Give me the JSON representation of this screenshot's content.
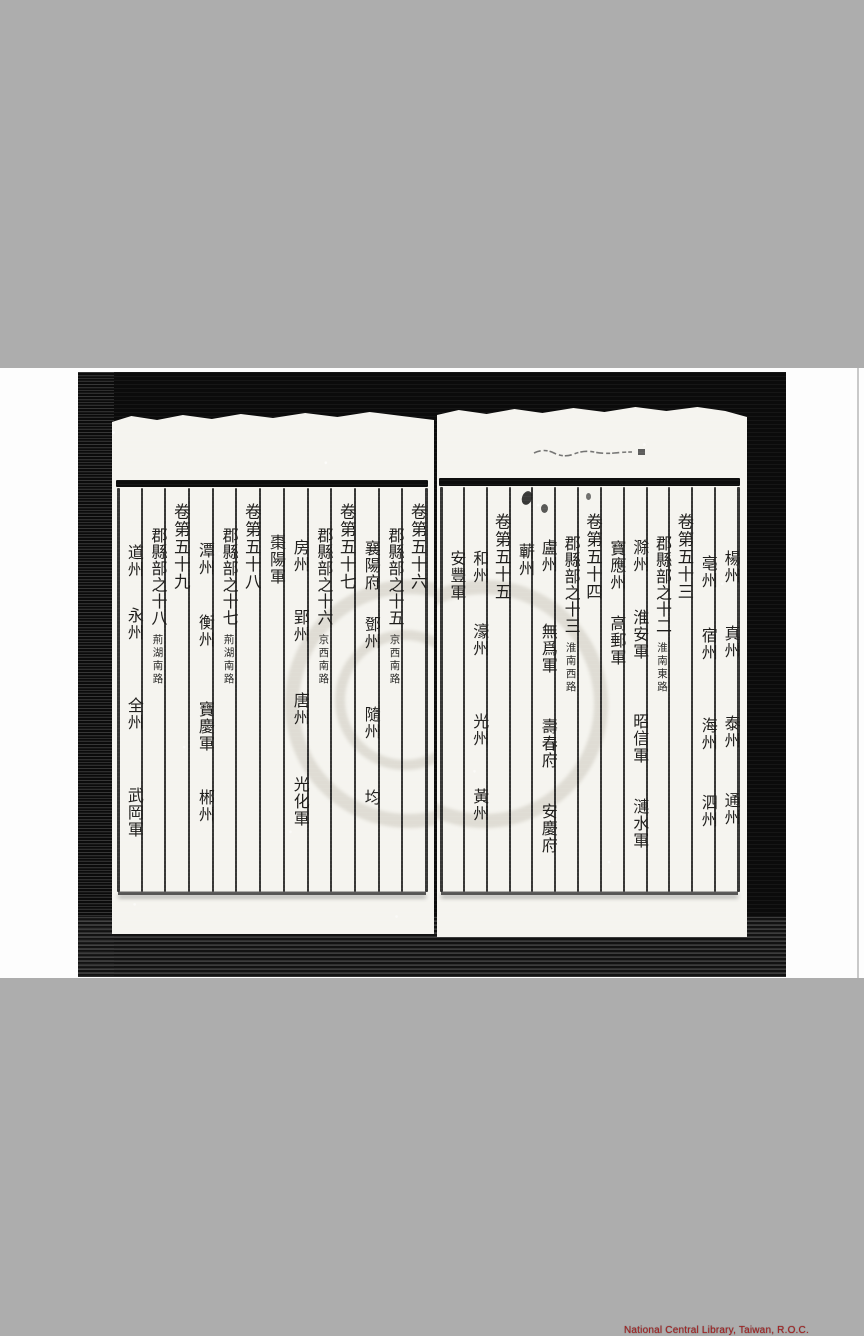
{
  "viewer": {
    "watermark_text": "National Central Library, Taiwan, R.O.C.",
    "watermark_color": "#a82020",
    "background_gray": "#adadad",
    "panel_white": "#fdfdfd",
    "scan_black": "#0b0b0b",
    "paper_color": "#f5f4ef",
    "ink_color": "#1e1d1b"
  },
  "book": {
    "description": "table of contents of a Chinese classical gazetteer, vertical columns read right to left",
    "right_page": {
      "columns": [
        {
          "items": [
            {
              "t": "楊州",
              "y": 145
            },
            {
              "t": "真州",
              "y": 220
            },
            {
              "t": "泰州",
              "y": 310
            },
            {
              "t": "通州",
              "y": 387
            }
          ]
        },
        {
          "items": [
            {
              "t": "亳州",
              "y": 150
            },
            {
              "t": "宿州",
              "y": 222
            },
            {
              "t": "海州",
              "y": 312
            },
            {
              "t": "泗州",
              "y": 389
            }
          ]
        },
        {
          "items": [
            {
              "t": "卷第五十三",
              "y": 108
            }
          ]
        },
        {
          "items": [
            {
              "t": "郡縣部之十二",
              "y": 130
            },
            {
              "t": "淮南東路",
              "y": 237,
              "small": true
            }
          ]
        },
        {
          "items": [
            {
              "t": "滁州",
              "y": 134
            },
            {
              "t": "淮安軍",
              "y": 204
            },
            {
              "t": "昭信軍",
              "y": 308
            },
            {
              "t": "漣水軍",
              "y": 393
            }
          ]
        },
        {
          "items": [
            {
              "t": "寶應州",
              "y": 135
            },
            {
              "t": "高郵軍",
              "y": 210
            }
          ]
        },
        {
          "items": [
            {
              "t": "卷第五十四",
              "y": 108
            }
          ]
        },
        {
          "items": [
            {
              "t": "郡縣部之十三",
              "y": 130
            },
            {
              "t": "淮南西路",
              "y": 237,
              "small": true
            }
          ]
        },
        {
          "items": [
            {
              "t": "盧州",
              "y": 134
            },
            {
              "t": "無爲軍",
              "y": 218
            },
            {
              "t": "壽春府",
              "y": 313
            },
            {
              "t": "安慶府",
              "y": 398
            }
          ]
        },
        {
          "items": [
            {
              "t": "蘄州",
              "y": 138
            }
          ]
        },
        {
          "items": [
            {
              "t": "卷第五十五",
              "y": 108
            }
          ]
        },
        {
          "items": [
            {
              "t": "和州",
              "y": 145
            },
            {
              "t": "濠州",
              "y": 218
            },
            {
              "t": "光州",
              "y": 308
            },
            {
              "t": "黃州",
              "y": 383
            }
          ]
        },
        {
          "items": [
            {
              "t": "安豐軍",
              "y": 145
            }
          ]
        }
      ]
    },
    "left_page": {
      "columns": [
        {
          "items": [
            {
              "t": "卷第五十六",
              "y": 93
            }
          ]
        },
        {
          "items": [
            {
              "t": "郡縣部之十五",
              "y": 117
            },
            {
              "t": "京西南路",
              "y": 224,
              "small": true
            }
          ]
        },
        {
          "items": [
            {
              "t": "襄陽府",
              "y": 130
            },
            {
              "t": "鄧州",
              "y": 206
            },
            {
              "t": "隨州",
              "y": 296
            },
            {
              "t": "均",
              "y": 379
            }
          ]
        },
        {
          "items": [
            {
              "t": "卷第五十七",
              "y": 93
            }
          ]
        },
        {
          "items": [
            {
              "t": "郡縣部之十六",
              "y": 117
            },
            {
              "t": "京西南路",
              "y": 224,
              "small": true
            }
          ]
        },
        {
          "items": [
            {
              "t": "房州",
              "y": 129
            },
            {
              "t": "郢州",
              "y": 199
            },
            {
              "t": "唐州",
              "y": 282
            },
            {
              "t": "光化軍",
              "y": 366
            }
          ]
        },
        {
          "items": [
            {
              "t": "棗陽軍",
              "y": 124
            }
          ]
        },
        {
          "items": [
            {
              "t": "卷第五十八",
              "y": 93
            }
          ]
        },
        {
          "items": [
            {
              "t": "郡縣部之十七",
              "y": 117
            },
            {
              "t": "荊湖南路",
              "y": 224,
              "small": true
            }
          ]
        },
        {
          "items": [
            {
              "t": "潭州",
              "y": 132
            },
            {
              "t": "衡州",
              "y": 204
            },
            {
              "t": "寶慶軍",
              "y": 291
            },
            {
              "t": "郴州",
              "y": 379
            }
          ]
        },
        {
          "items": [
            {
              "t": "卷第五十九",
              "y": 93
            }
          ]
        },
        {
          "items": [
            {
              "t": "郡縣部之十八",
              "y": 117
            },
            {
              "t": "荊湖南路",
              "y": 224,
              "small": true
            }
          ]
        },
        {
          "items": [
            {
              "t": "道州",
              "y": 134
            },
            {
              "t": "永州",
              "y": 197
            },
            {
              "t": "全州",
              "y": 287
            },
            {
              "t": "武岡軍",
              "y": 377
            }
          ]
        }
      ]
    }
  }
}
